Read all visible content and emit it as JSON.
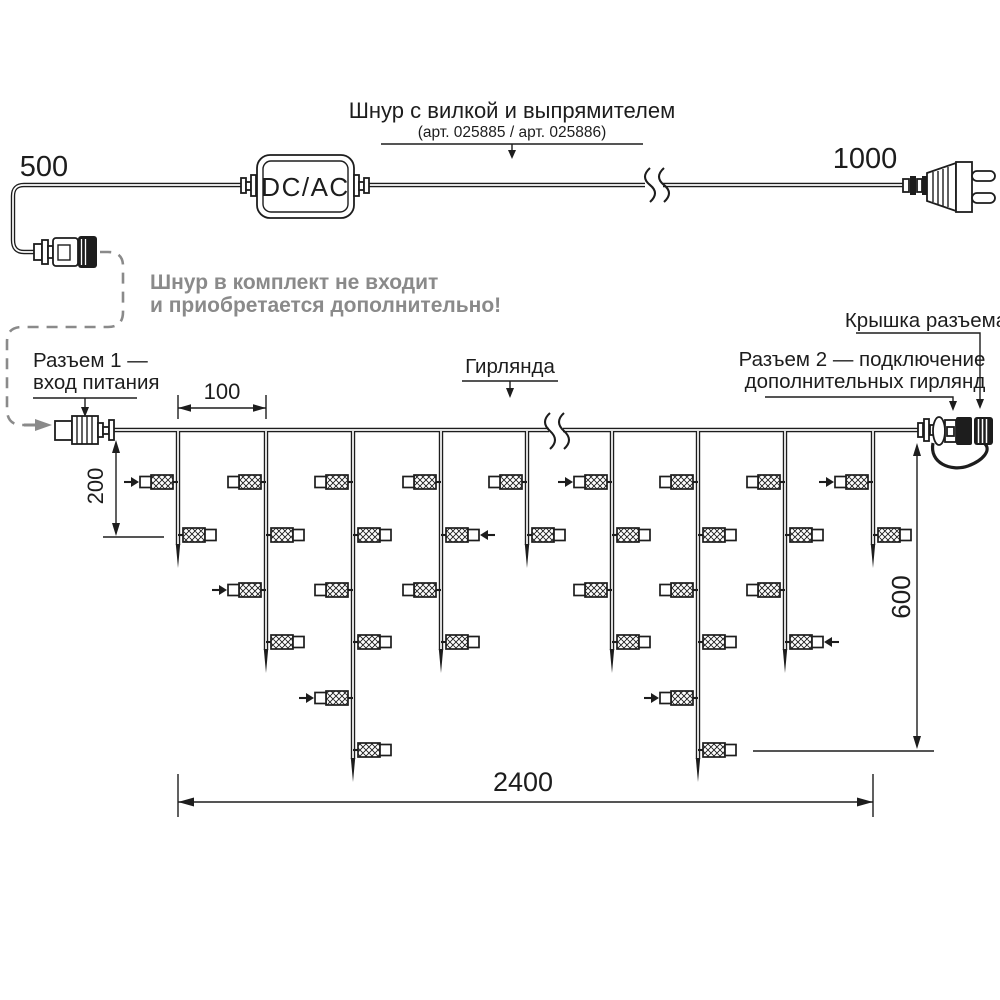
{
  "title_block": {
    "cord_label_line1": "Шнур с вилкой и выпрямителем",
    "cord_label_line2": "(арт. 025885 / арт. 025886)"
  },
  "adapter_label": "DC/AC",
  "note": {
    "line1": "Шнур в комплект не входит",
    "line2": "и приобретается дополнительно!"
  },
  "callouts": {
    "connector1_line1": "Разъем 1 —",
    "connector1_line2": "вход питания",
    "garland": "Гирлянда",
    "connector2_line1": "Разъем 2 — подключение",
    "connector2_line2": "дополнительных гирлянд",
    "cap": "Крышка разъема"
  },
  "dimensions": {
    "cord_to_connector": "500",
    "cord_to_plug": "1000",
    "drop_spacing": "100",
    "first_lamp_offset": "200",
    "drop_depth": "600",
    "garland_width": "2400"
  },
  "colors": {
    "line": "#1d1d1d",
    "muted": "#8a8a8a",
    "background": "#ffffff"
  },
  "garland": {
    "wire_y": 430,
    "wire_x_start": 114,
    "wire_x_end": 920,
    "break_x": 556,
    "lamp_row_ys": [
      482,
      535,
      590,
      642,
      698,
      750
    ],
    "drops": [
      {
        "x": 178,
        "tip_y": 568,
        "lamp_count": 2,
        "flash_rows": [
          1
        ]
      },
      {
        "x": 266,
        "tip_y": 673,
        "lamp_count": 4,
        "flash_rows": [
          3
        ]
      },
      {
        "x": 353,
        "tip_y": 782,
        "lamp_count": 6,
        "flash_rows": [
          5
        ]
      },
      {
        "x": 441,
        "tip_y": 673,
        "lamp_count": 4,
        "flash_rows": [
          2
        ]
      },
      {
        "x": 527,
        "tip_y": 568,
        "lamp_count": 2,
        "flash_rows": []
      },
      {
        "x": 612,
        "tip_y": 673,
        "lamp_count": 4,
        "flash_rows": [
          1
        ]
      },
      {
        "x": 698,
        "tip_y": 782,
        "lamp_count": 6,
        "flash_rows": [
          5
        ]
      },
      {
        "x": 785,
        "tip_y": 673,
        "lamp_count": 4,
        "flash_rows": [
          4
        ]
      },
      {
        "x": 873,
        "tip_y": 568,
        "lamp_count": 2,
        "flash_rows": [
          1
        ]
      }
    ]
  }
}
